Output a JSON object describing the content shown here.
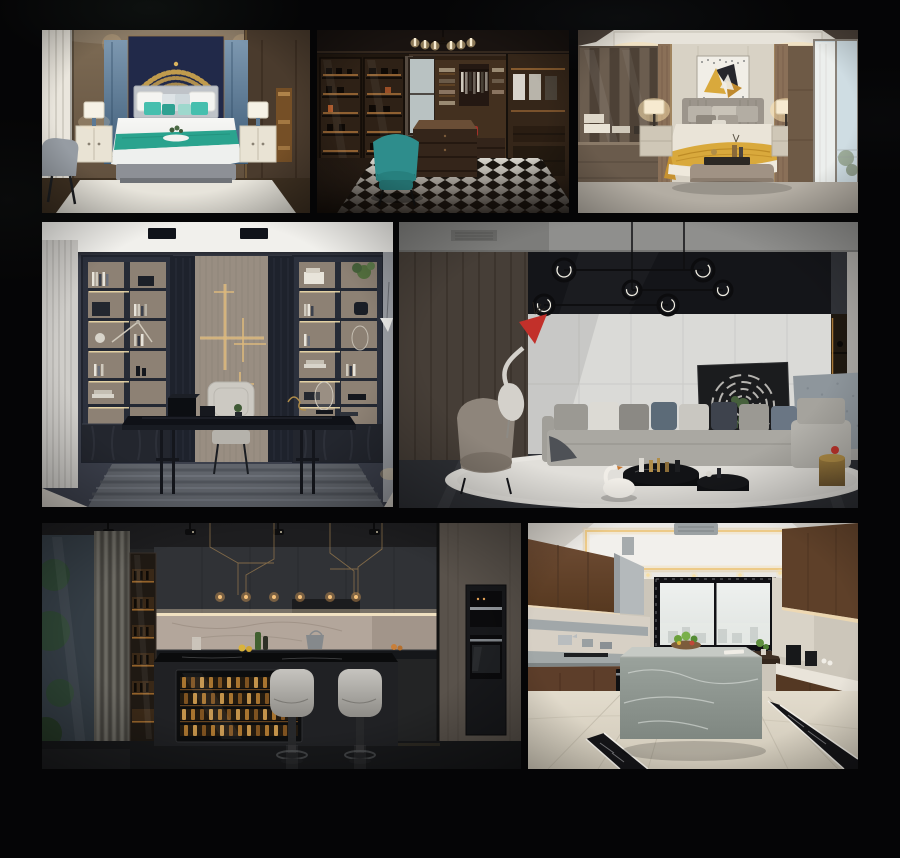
{
  "page": {
    "title": "Interior design photo collage",
    "background_color": "#050506"
  },
  "gallery": {
    "items": [
      {
        "id": "bedroom-navy",
        "label": "Bedroom with navy headboard wall, gold ornament, white bed and teal accent pillows",
        "dominant_colors": [
          "#6e5d4a",
          "#222a4c",
          "#45bfae",
          "#f1f2f0",
          "#c9a14e"
        ]
      },
      {
        "id": "walk-in-closet",
        "label": "Dark wood walk-in closet with backlit display shelves, chandelier, teal armchair and black-white chevron floor",
        "dominant_colors": [
          "#2b211a",
          "#a06a2e",
          "#2e8d8c",
          "#d8d5cd"
        ]
      },
      {
        "id": "bedroom-gold",
        "label": "Beige bedroom with abstract gold artwork, upholstered headboard, mustard throw and balcony door",
        "dominant_colors": [
          "#cfc9bc",
          "#d9a93c",
          "#9c958c",
          "#cfdde3"
        ]
      },
      {
        "id": "study",
        "label": "Dark blue-gray study with bookshelves, brass wall art, black desk and striped rug",
        "dominant_colors": [
          "#3c404c",
          "#8d8174",
          "#dcb87c",
          "#60646b"
        ]
      },
      {
        "id": "living-room",
        "label": "Modern living room with ring pendant lights, gray sofa, round white rug and crane sculpture with red flag",
        "dominant_colors": [
          "#463e37",
          "#dadad7",
          "#141519",
          "#e7e5e0",
          "#c2302a"
        ]
      },
      {
        "id": "kitchen-bar",
        "label": "Dark kitchen bar with wine cooler island, two light gray bar stools and backlit marble splashback",
        "dominant_colors": [
          "#232425",
          "#b3a69b",
          "#a8742f",
          "#c6c4bf"
        ]
      },
      {
        "id": "kitchen-island",
        "label": "Bright galley kitchen with gray marble island, walnut cabinets, large window and cove-lit ceiling",
        "dominant_colors": [
          "#ccc6ba",
          "#5d3e2a",
          "#9aa29c",
          "#eae8e4"
        ]
      }
    ]
  }
}
